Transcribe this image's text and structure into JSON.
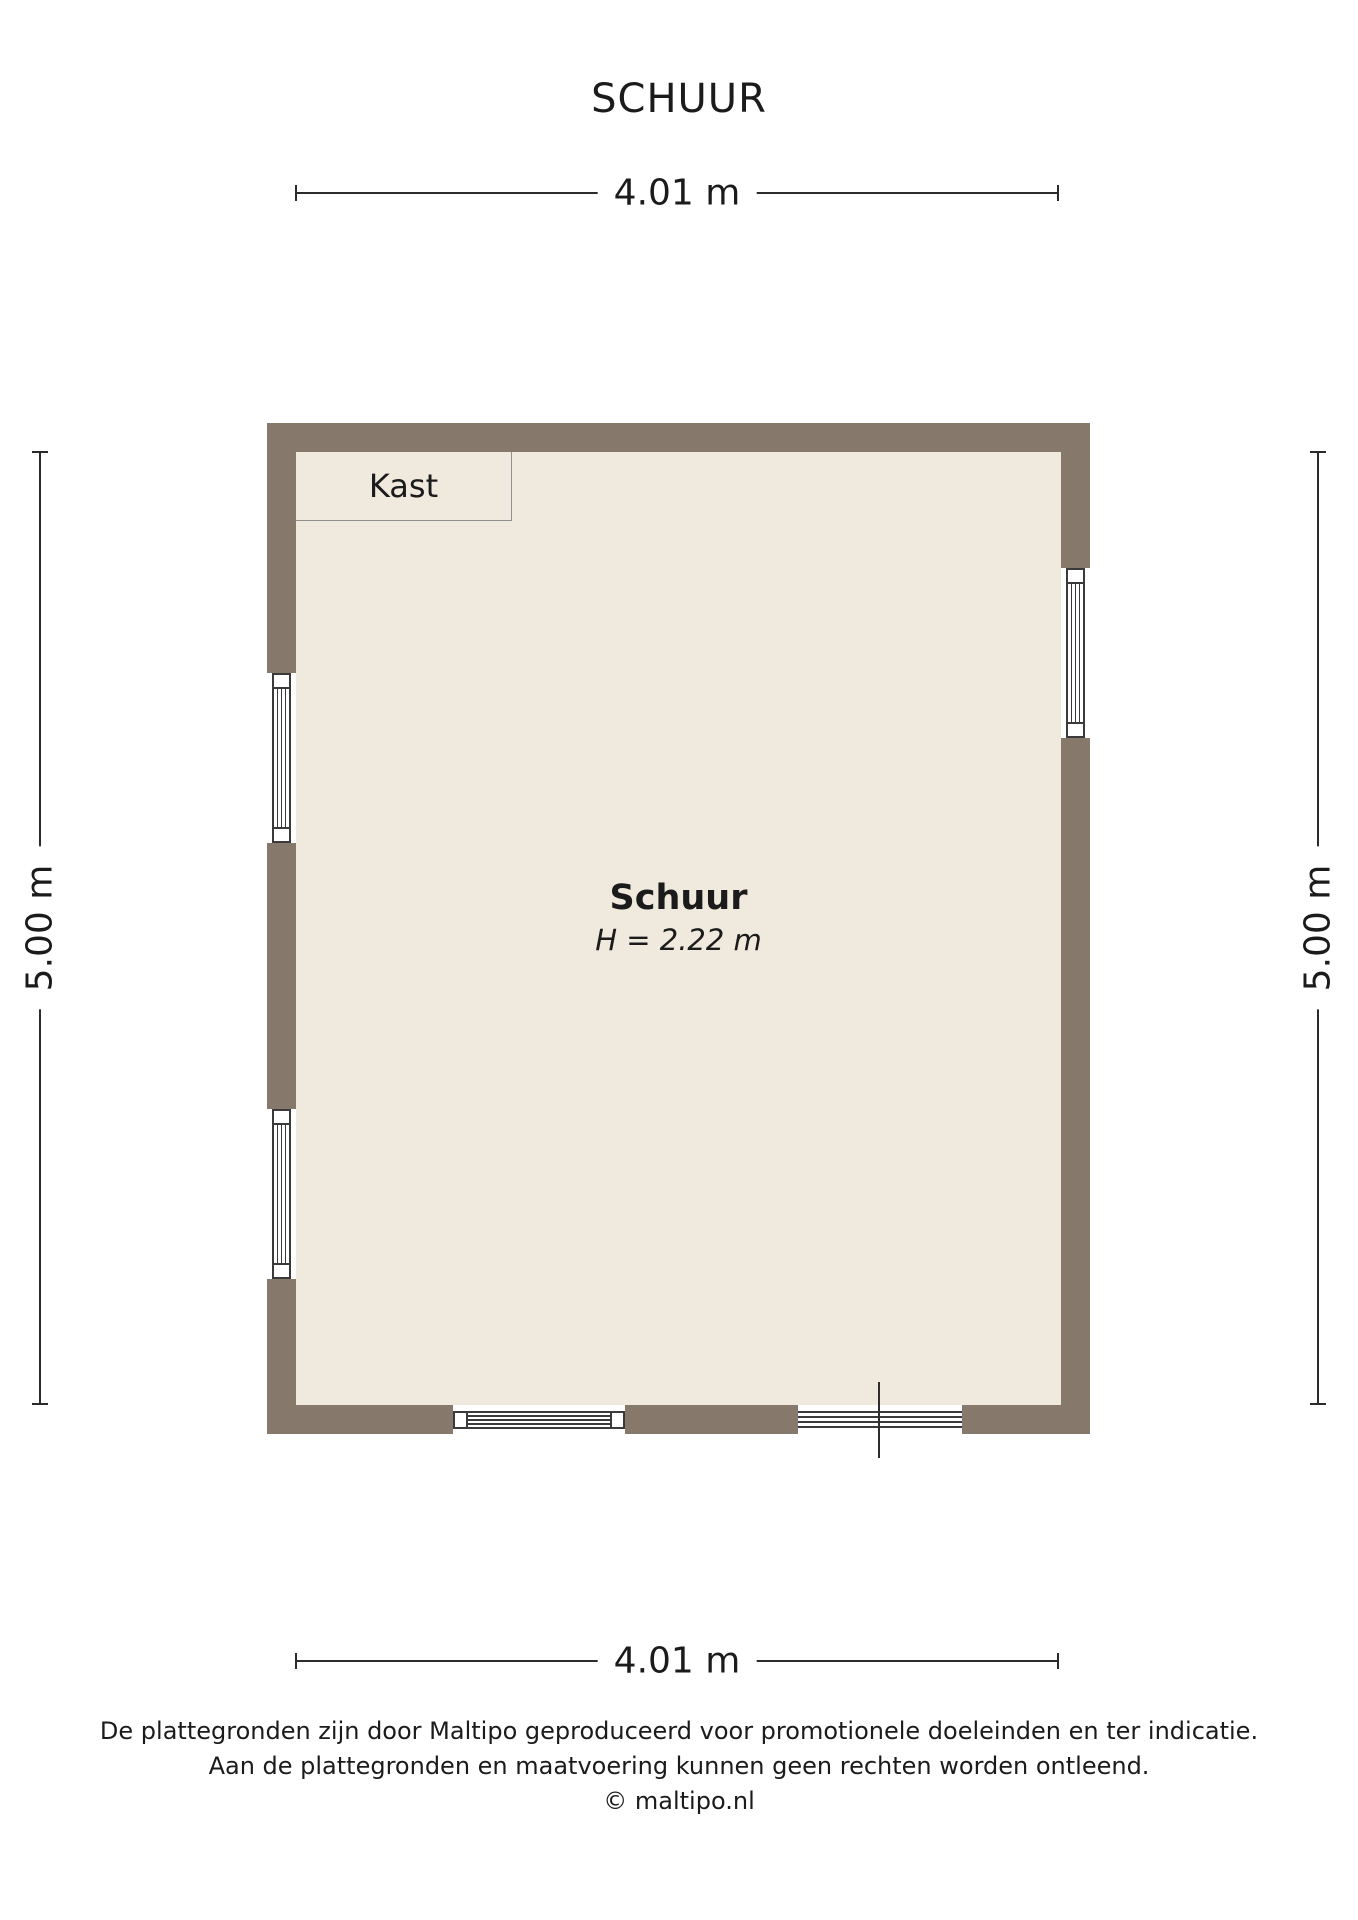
{
  "title": "SCHUUR",
  "dimensions": {
    "top": "4.01 m",
    "bottom": "4.01 m",
    "left": "5.00 m",
    "right": "5.00 m"
  },
  "room": {
    "name": "Schuur",
    "height_label": "H = 2.22 m"
  },
  "closet_label": "Kast",
  "footer": {
    "line1": "De plattegronden zijn door Maltipo geproduceerd voor promotionele doeleinden en ter indicatie.",
    "line2": "Aan de plattegronden en maatvoering kunnen geen rechten worden ontleend.",
    "copyright": "© maltipo.nl"
  },
  "colors": {
    "wall": "#86786A",
    "floor": "#EFE9DE",
    "line": "#2B2B2B",
    "frame": "#3A3A3A",
    "text": "#1B1B1B"
  }
}
